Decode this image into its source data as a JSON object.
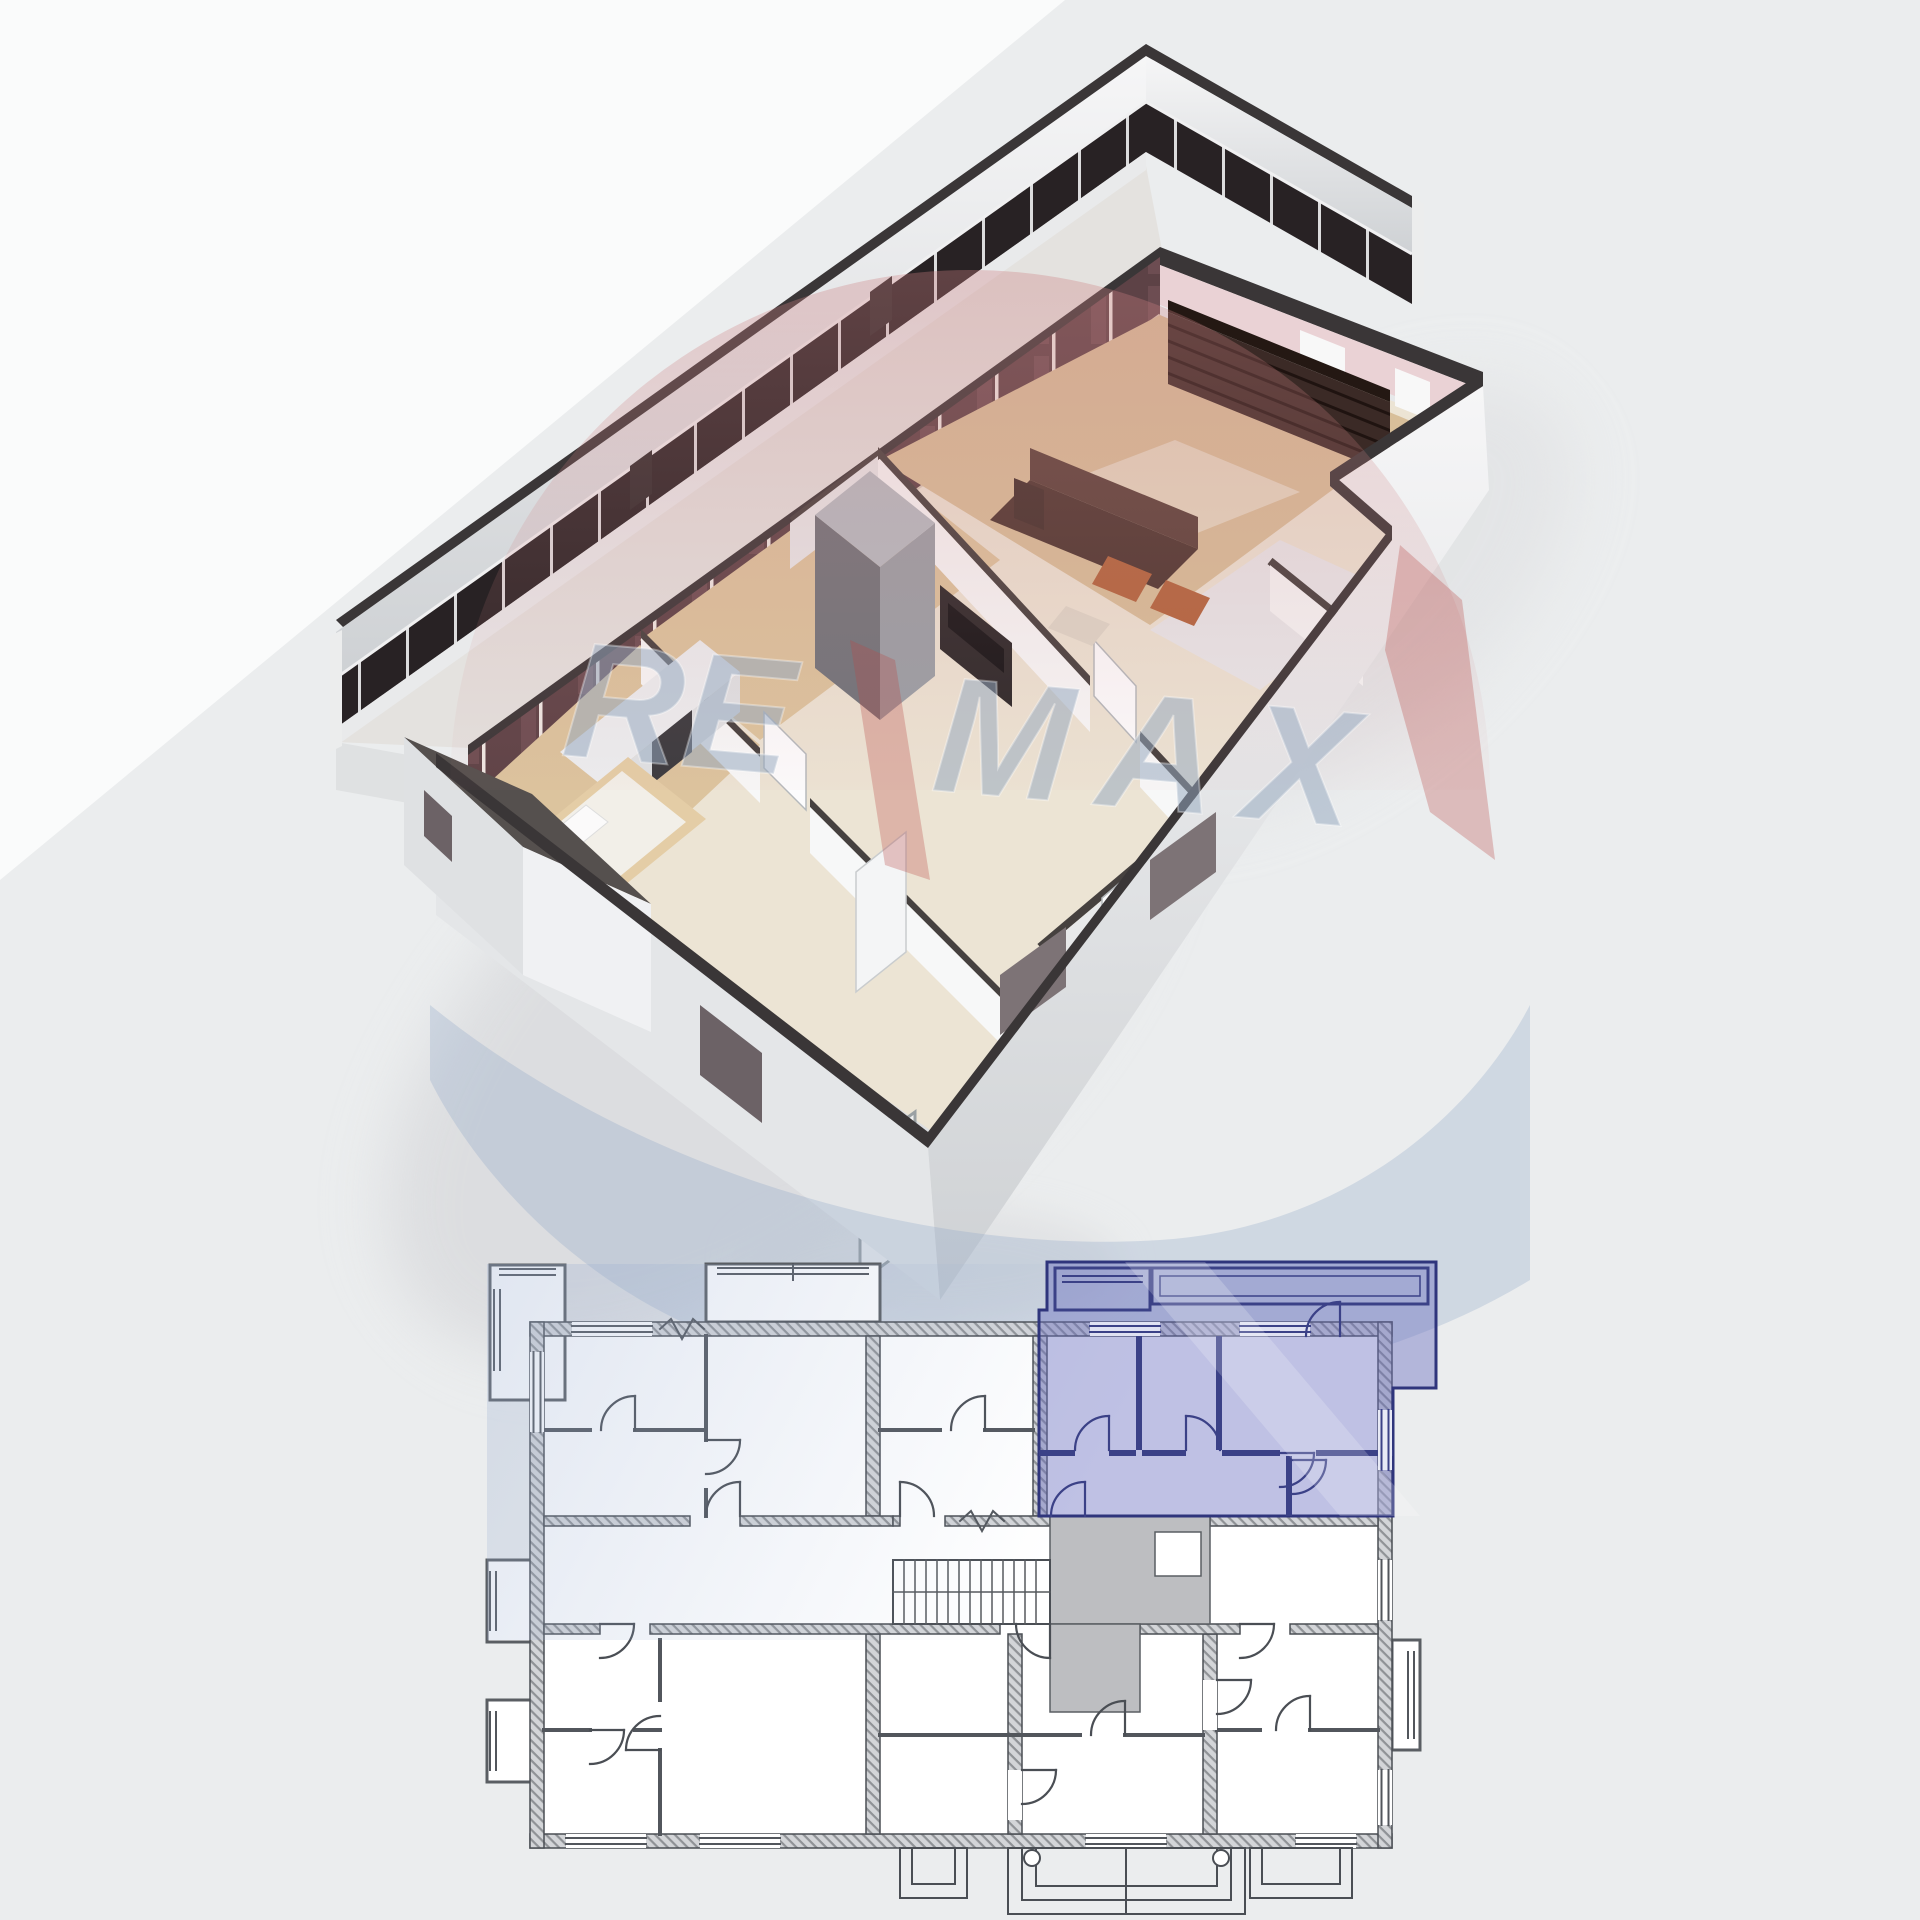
{
  "scene": {
    "upper": "3d-cutaway-apartment-floor-plan",
    "lower": "2d-building-floor-plan-with-highlighted-unit",
    "highlighted_unit_position": "top-right"
  },
  "watermark": {
    "brand": "RE/MAX",
    "part1": "RE",
    "part2": "MAX",
    "balloon_pink": "#cd8082",
    "balloon_red": "#b94846",
    "wave_blue": "#8aa0c6",
    "text_blue": "#96a8c0"
  },
  "palette": {
    "background": "#ebedee",
    "background_highlight": "#fafbfb",
    "wall_top_dark": "#3a3637",
    "window_band_maroon": "#5d4246",
    "balcony_glass": "#282224",
    "exterior_wall_light": "#eceeef",
    "floor_wood": "#d8bf9a",
    "floor_cream": "#ece4d4",
    "furniture_brown": "#4c3630",
    "furniture_orange": "#b2653e",
    "wardrobe_gray": "#9aa0a6",
    "plan_wall_gray": "#9b9ea2",
    "plan_line": "#4a4e54",
    "unit_highlight_fill": "#666cbe",
    "unit_highlight_border": "#2f357c",
    "core_gray": "#bdbec1"
  }
}
